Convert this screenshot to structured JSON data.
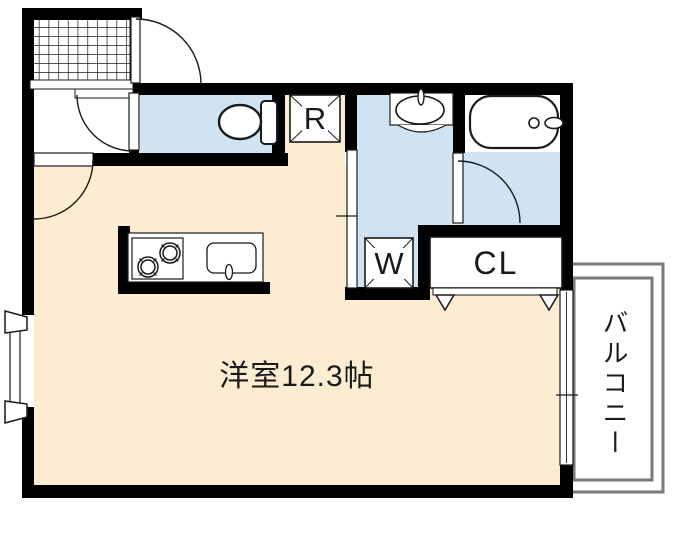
{
  "floorplan": {
    "labels": {
      "main_room": "洋室12.3帖",
      "balcony": "バルコニー",
      "closet": "CL",
      "refrigerator": "R",
      "washer": "W"
    },
    "colors": {
      "wall": "#000000",
      "room_fill": "#fbecd2",
      "wet_area_fill": "#cfe3f2",
      "balcony_outline": "#7a7a7a",
      "fixture_outline": "#000000",
      "background": "#ffffff"
    }
  }
}
